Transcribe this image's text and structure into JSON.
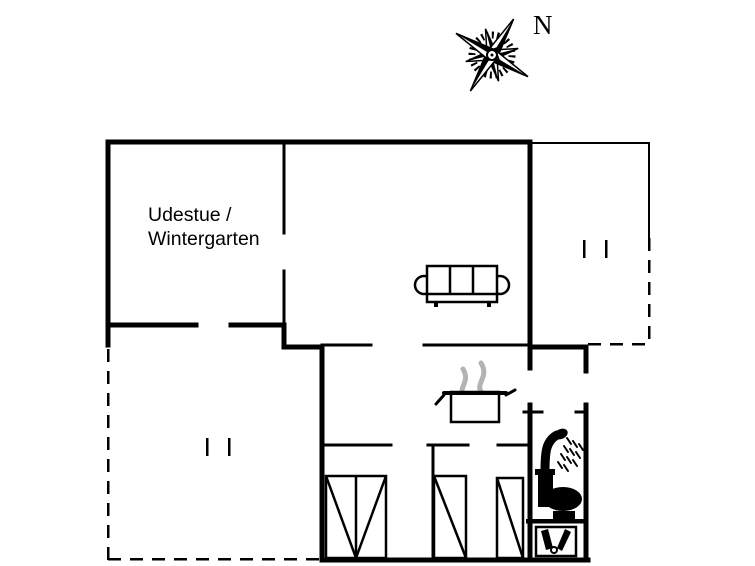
{
  "canvas": {
    "width": 755,
    "height": 566,
    "background": "#ffffff",
    "ink": "#000000",
    "steam_color": "#b3b3b3"
  },
  "compass": {
    "label": "N"
  },
  "room_label": {
    "line1": "Udestue /",
    "line2": "Wintergarten"
  },
  "icons": {
    "compass": "compass-rose-icon",
    "sofa": "sofa-icon",
    "pot": "cooking-pot-icon",
    "steam": "steam-icon",
    "shower": "shower-icon",
    "toilet": "toilet-icon",
    "sink": "sink-icon",
    "double_bed": "double-bed-icon",
    "single_bed": "single-bed-icon",
    "opening_marks": "opening-marks"
  }
}
